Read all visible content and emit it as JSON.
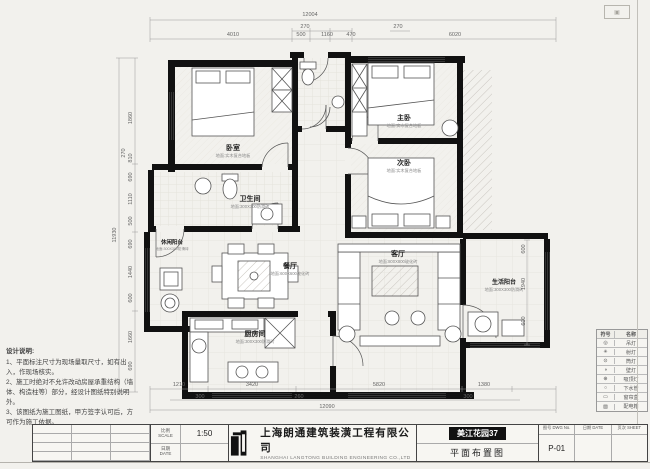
{
  "plan": {
    "dims": {
      "top_overall": "12004",
      "top_row2": [
        "270",
        "270"
      ],
      "top_row3": [
        "4010",
        "500",
        "1160",
        "470",
        "6020"
      ],
      "left_overall": "11930",
      "left_chain": [
        "1860",
        "270",
        "810",
        "690",
        "1110",
        "500",
        "690",
        "1440",
        "600",
        "1660",
        "690"
      ],
      "right_chain": [
        "600",
        "1940",
        "600"
      ],
      "bottom_row1": [
        "1210",
        "3420",
        "5820",
        "1380"
      ],
      "bottom_row2": [
        "300",
        "260",
        "300"
      ],
      "bottom_overall": "12090"
    },
    "rooms": [
      {
        "name": "卧室",
        "floor": "地面:实木复合地板"
      },
      {
        "name": "主卧",
        "floor": "地面:实木复合地板"
      },
      {
        "name": "次卧",
        "floor": "地面:实木复合地板"
      },
      {
        "name": "卫生间",
        "floor": "地面:300X300防滑砖"
      },
      {
        "name": "餐厅",
        "floor": "地面:600X600玻化砖"
      },
      {
        "name": "客厅",
        "floor": "地面:800X800玻化砖"
      },
      {
        "name": "厨房间",
        "floor": "地面:300X300防滑砖"
      },
      {
        "name": "休闲阳台",
        "floor": "地面:300X300防滑砖"
      },
      {
        "name": "生活阳台",
        "floor": "地面:300X300防滑砖"
      }
    ]
  },
  "notes": {
    "title": "设计说明:",
    "lines": [
      "1、平面标注尺寸为现场量取尺寸，如有出入，作现场核实。",
      "2、施工时绝对不允许改动房屋承重结构（墙体、构造柱等）部分，经设计图纸特别说明外。",
      "3、该图纸为施工图纸，甲方签字认可后，方可作为施工依据。"
    ]
  },
  "legend": {
    "col_symbol": "符号",
    "col_name": "名称",
    "items": [
      {
        "symbol": "◎",
        "name": "吊灯"
      },
      {
        "symbol": "✳",
        "name": "射灯"
      },
      {
        "symbol": "⊙",
        "name": "筒灯"
      },
      {
        "symbol": "◑",
        "name": "壁灯"
      },
      {
        "symbol": "⊕",
        "name": "吸顶灯"
      },
      {
        "symbol": "○",
        "name": "下水管"
      },
      {
        "symbol": "▭",
        "name": "窗帘盒"
      },
      {
        "symbol": "▨",
        "name": "配电箱"
      }
    ]
  },
  "title_block": {
    "company_cn": "上海朗通建筑装潢工程有限公司",
    "company_en": "SHANGHAI LANGTONG BUILDING ENGINEERING CO.,LTD",
    "scale_label_cn": "比例",
    "scale_label_en": "SCALE",
    "scale_value": "1:50",
    "date_label_cn": "日期",
    "date_label_en": "DATE",
    "project": "美江花园37",
    "drawing_title": "平面布置图",
    "dwgno_label_cn": "图号",
    "dwgno_label_en": "DWG No.",
    "drawing_no": "P-01",
    "sheet_label_cn": "页次",
    "sheet_label_en": "SHEET"
  }
}
